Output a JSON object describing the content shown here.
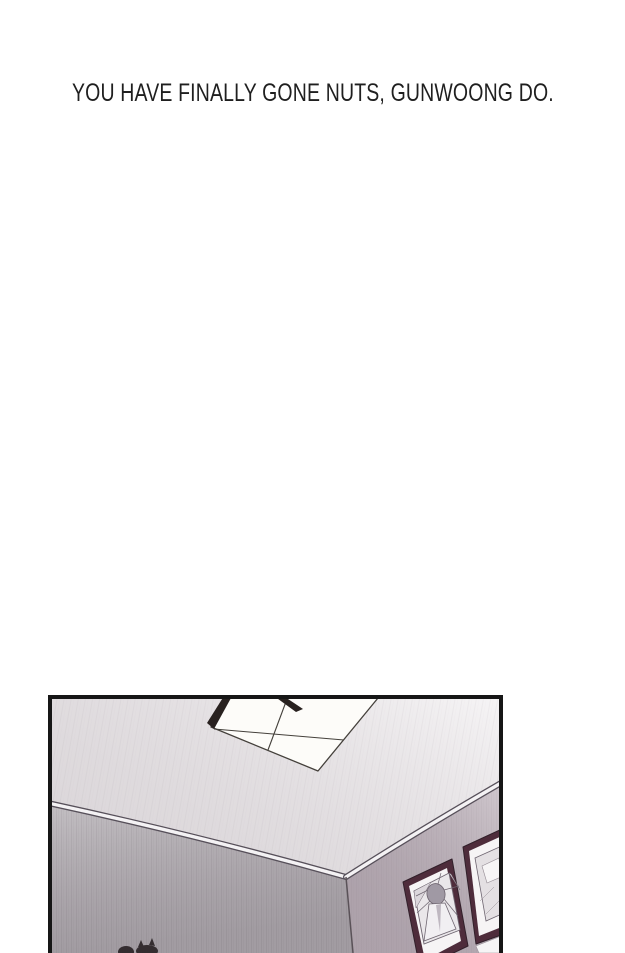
{
  "caption": {
    "text": "YOU HAVE FINALLY GONE NUTS, GUNWOONG DO.",
    "color": "#1f1f1f"
  },
  "panel": {
    "border_color": "#161616",
    "colors": {
      "ceiling": "#efecee",
      "left_wall": "#b3aeb3",
      "right_wall": "#bcb0b9",
      "molding_dark": "#57505a",
      "molding_light": "#f4f2f4",
      "corner_line": "#5a5258",
      "light_panel": "#fdfcf9",
      "light_edge": "#44403b",
      "light_housing": "#28211f",
      "frame_wood": "#4e2c3b",
      "frame_matte": "#f6f4f5",
      "art_bg": "#eae7ea",
      "art_line": "#6e6570",
      "art_head": "#a099a4",
      "blob": "#342d30"
    }
  }
}
